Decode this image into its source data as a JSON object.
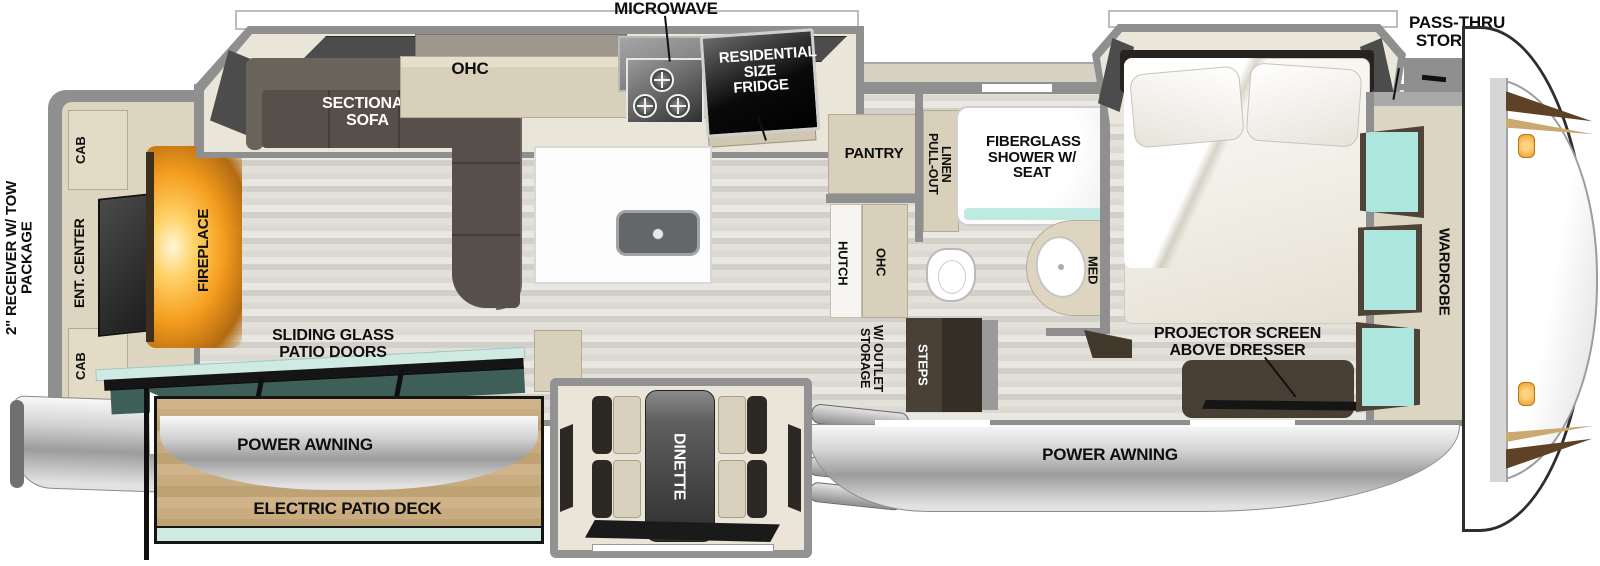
{
  "title": "Fifth wheel RV floor plan",
  "labels": {
    "rear": {
      "receiver": "2\" RECEIVER W/ TOW PACKAGE",
      "cab_top": "CAB",
      "ent_center": "ENT. CENTER",
      "cab_bottom": "CAB",
      "fireplace": "FIREPLACE"
    },
    "living": {
      "sofa": "SECTIONAL SOFA",
      "sliding_doors": "SLIDING GLASS PATIO DOORS",
      "power_awning": "POWER AWNING",
      "electric_patio_deck": "ELECTRIC PATIO DECK"
    },
    "kitchen": {
      "microwave": "MICROWAVE",
      "ohc": "OHC",
      "fridge": "RESIDENTIAL SIZE FRIDGE",
      "pantry": "PANTRY"
    },
    "dinette": {
      "label": "DINETTE"
    },
    "bath": {
      "pull_out_linen": "PULL-OUT LINEN",
      "shower": "FIBERGLASS SHOWER W/ SEAT",
      "med": "MED",
      "hutch": "HUTCH",
      "ohc": "OHC"
    },
    "entry": {
      "storage_outlet": "STORAGE W/ OUTLET",
      "steps": "STEPS",
      "power_awning": "POWER AWNING"
    },
    "bedroom": {
      "projector": "PROJECTOR SCREEN ABOVE DRESSER"
    },
    "front": {
      "pass_thru": "PASS-THRU STORAGE",
      "wardrobe": "WARDROBE",
      "washer_dryer": "STACKABLE WASHER/DRYER PREP"
    }
  },
  "colors": {
    "wall": "#8f8f8f",
    "cabinet_tan": "#d8d0bb",
    "furniture_dark": "#57504a",
    "dresser_brown": "#473e34",
    "floor_light": "#e3e0da",
    "deck_wood": "#c9ab80",
    "glass_teal": "#aee6de",
    "patio_glass": "#3d5f58",
    "awning_silver": "#c9c9c9",
    "fireplace_orange": "#f49d1d",
    "cap_accent_brown": "#5e4226",
    "marker_light_orange": "#f0a63c"
  }
}
